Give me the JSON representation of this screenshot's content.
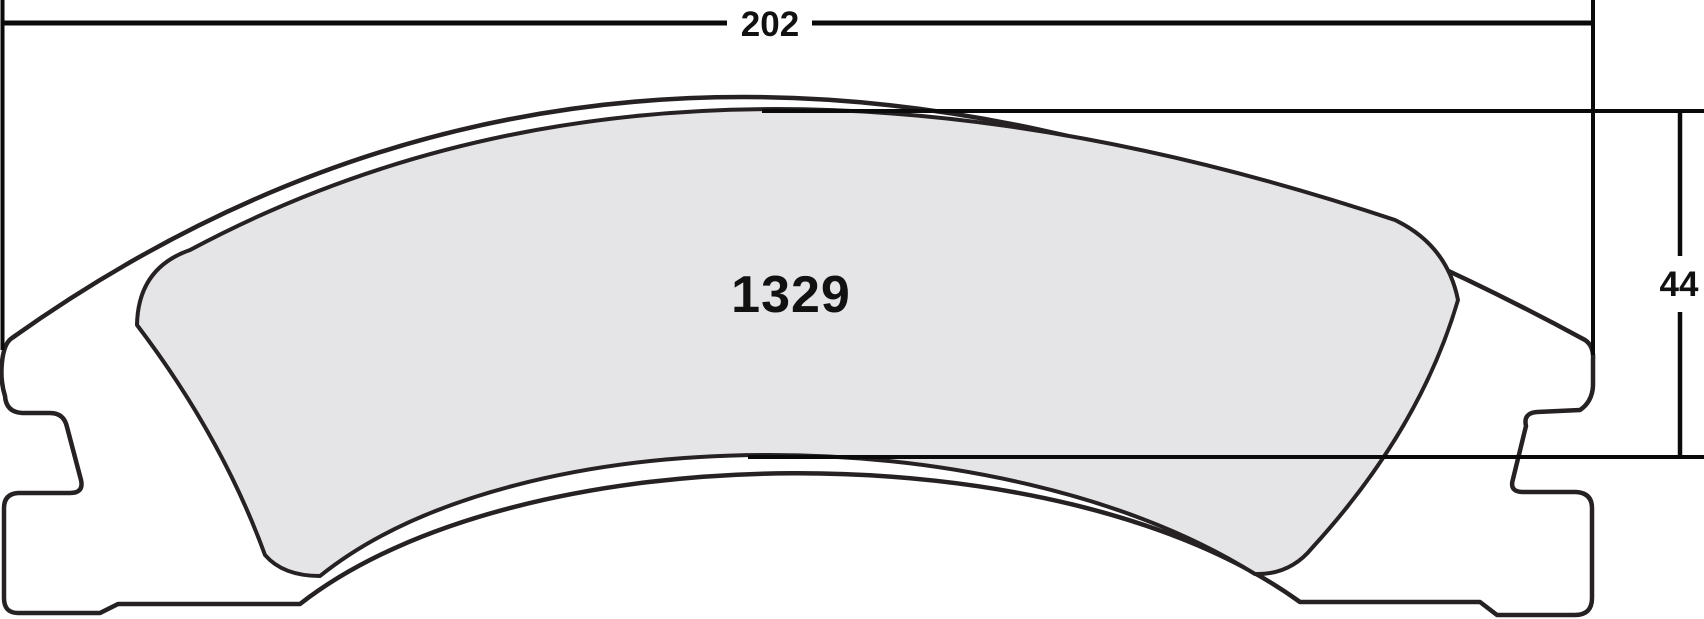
{
  "drawing": {
    "title": "brake-pad-dimension-drawing",
    "part_number": "1329",
    "dimensions": {
      "width": {
        "value": "202",
        "orientation": "horizontal",
        "position": "top"
      },
      "height": {
        "value": "44",
        "orientation": "vertical",
        "position": "right"
      }
    },
    "colors": {
      "background": "#ffffff",
      "outline": "#262223",
      "dimension_line": "#0a0a0a",
      "friction_fill": "#e5e4e6",
      "plate_fill": "#ffffff",
      "text": "#111111"
    }
  }
}
